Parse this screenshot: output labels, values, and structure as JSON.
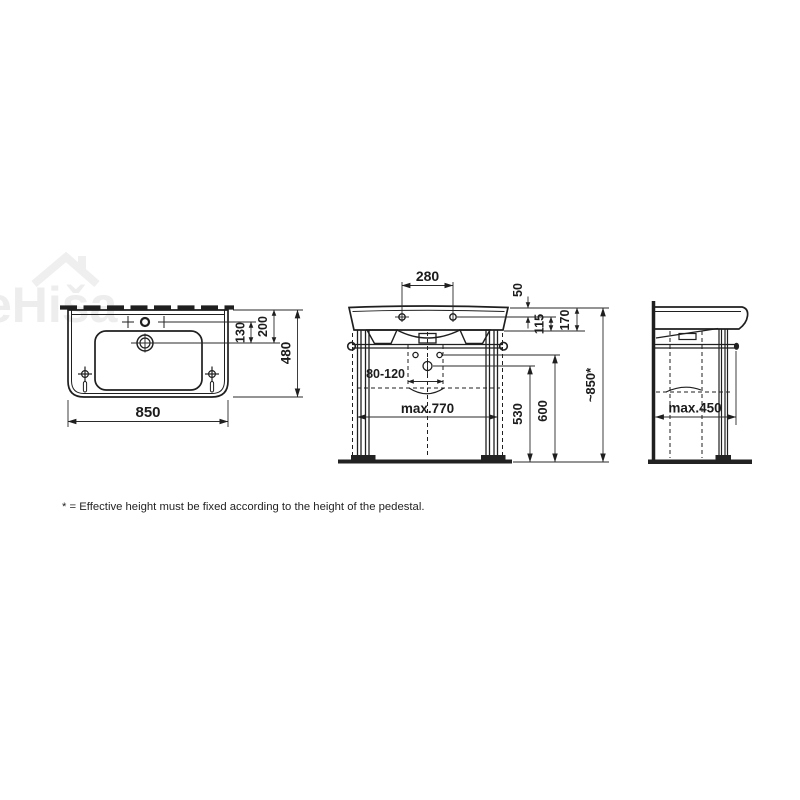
{
  "watermark": {
    "text": "eHiša"
  },
  "footnote": "* = Effective height must be fixed according to the height of the pedestal.",
  "top_view": {
    "width": "850",
    "depth": "480",
    "rim_to_drain": "200",
    "tap_line_to_drain": "130"
  },
  "front_view": {
    "tap_hole_spacing": "280",
    "top_to_tap_axis": "50",
    "tap_axis_to_rim_bottom": "115",
    "ceramic_height": "170",
    "drain_height_range": "80-120",
    "frame_width": "max.770",
    "drain_to_floor": "530",
    "fixing_to_floor": "600",
    "overall_height": "~850*"
  },
  "side_view": {
    "depth": "max.450"
  },
  "colors": {
    "line": "#1f1f1f",
    "dim_line": "#2a2a2a",
    "watermark": "#ededed",
    "background": "#ffffff"
  }
}
